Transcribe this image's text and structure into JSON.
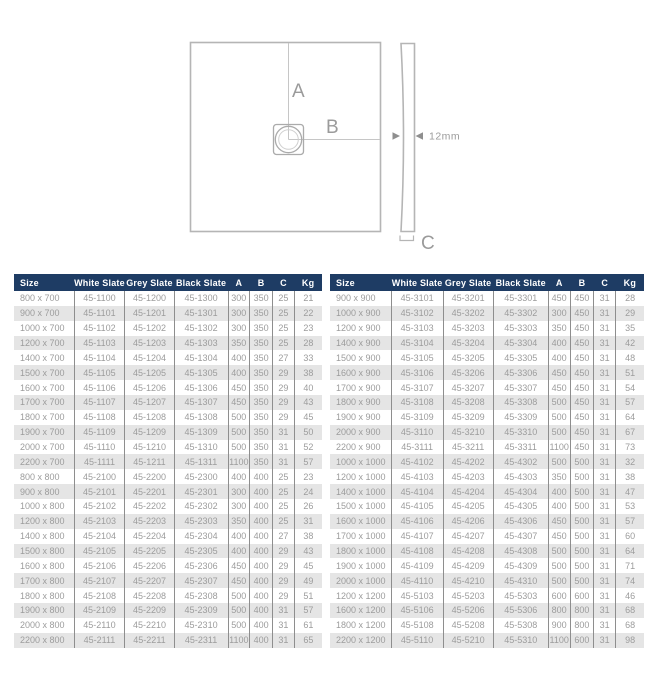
{
  "diagram": {
    "label_a": "A",
    "label_b": "B",
    "label_c": "C",
    "thickness_label": "12mm"
  },
  "colors": {
    "header_bg": "#1e3c64",
    "header_text": "#ffffff",
    "row_alt": "#e5e5e5",
    "body_text": "#9c9c9c",
    "divider": "#8e8e8e",
    "diagram_stroke": "#b5b5b5"
  },
  "tables": [
    {
      "columns": [
        "Size",
        "White Slate",
        "Grey Slate",
        "Black Slate",
        "A",
        "B",
        "C",
        "Kg"
      ],
      "rows": [
        [
          "800 x 700",
          "45-1100",
          "45-1200",
          "45-1300",
          "300",
          "350",
          "25",
          "21"
        ],
        [
          "900 x 700",
          "45-1101",
          "45-1201",
          "45-1301",
          "300",
          "350",
          "25",
          "22"
        ],
        [
          "1000 x 700",
          "45-1102",
          "45-1202",
          "45-1302",
          "300",
          "350",
          "25",
          "23"
        ],
        [
          "1200 x 700",
          "45-1103",
          "45-1203",
          "45-1303",
          "350",
          "350",
          "25",
          "28"
        ],
        [
          "1400 x 700",
          "45-1104",
          "45-1204",
          "45-1304",
          "400",
          "350",
          "27",
          "33"
        ],
        [
          "1500 x 700",
          "45-1105",
          "45-1205",
          "45-1305",
          "400",
          "350",
          "29",
          "38"
        ],
        [
          "1600 x 700",
          "45-1106",
          "45-1206",
          "45-1306",
          "450",
          "350",
          "29",
          "40"
        ],
        [
          "1700 x 700",
          "45-1107",
          "45-1207",
          "45-1307",
          "450",
          "350",
          "29",
          "43"
        ],
        [
          "1800 x 700",
          "45-1108",
          "45-1208",
          "45-1308",
          "500",
          "350",
          "29",
          "45"
        ],
        [
          "1900 x 700",
          "45-1109",
          "45-1209",
          "45-1309",
          "500",
          "350",
          "31",
          "50"
        ],
        [
          "2000 x 700",
          "45-1110",
          "45-1210",
          "45-1310",
          "500",
          "350",
          "31",
          "52"
        ],
        [
          "2200 x 700",
          "45-1111",
          "45-1211",
          "45-1311",
          "1100",
          "350",
          "31",
          "57"
        ],
        [
          "800 x 800",
          "45-2100",
          "45-2200",
          "45-2300",
          "400",
          "400",
          "25",
          "23"
        ],
        [
          "900 x 800",
          "45-2101",
          "45-2201",
          "45-2301",
          "300",
          "400",
          "25",
          "24"
        ],
        [
          "1000 x 800",
          "45-2102",
          "45-2202",
          "45-2302",
          "300",
          "400",
          "25",
          "26"
        ],
        [
          "1200 x 800",
          "45-2103",
          "45-2203",
          "45-2303",
          "350",
          "400",
          "25",
          "31"
        ],
        [
          "1400 x 800",
          "45-2104",
          "45-2204",
          "45-2304",
          "400",
          "400",
          "27",
          "38"
        ],
        [
          "1500 x 800",
          "45-2105",
          "45-2205",
          "45-2305",
          "400",
          "400",
          "29",
          "43"
        ],
        [
          "1600 x 800",
          "45-2106",
          "45-2206",
          "45-2306",
          "450",
          "400",
          "29",
          "45"
        ],
        [
          "1700 x 800",
          "45-2107",
          "45-2207",
          "45-2307",
          "450",
          "400",
          "29",
          "49"
        ],
        [
          "1800 x 800",
          "45-2108",
          "45-2208",
          "45-2308",
          "500",
          "400",
          "29",
          "51"
        ],
        [
          "1900 x 800",
          "45-2109",
          "45-2209",
          "45-2309",
          "500",
          "400",
          "31",
          "57"
        ],
        [
          "2000 x 800",
          "45-2110",
          "45-2210",
          "45-2310",
          "500",
          "400",
          "31",
          "61"
        ],
        [
          "2200 x 800",
          "45-2111",
          "45-2211",
          "45-2311",
          "1100",
          "400",
          "31",
          "65"
        ]
      ]
    },
    {
      "columns": [
        "Size",
        "White Slate",
        "Grey Slate",
        "Black Slate",
        "A",
        "B",
        "C",
        "Kg"
      ],
      "rows": [
        [
          "900 x 900",
          "45-3101",
          "45-3201",
          "45-3301",
          "450",
          "450",
          "31",
          "28"
        ],
        [
          "1000 x 900",
          "45-3102",
          "45-3202",
          "45-3302",
          "300",
          "450",
          "31",
          "29"
        ],
        [
          "1200 x 900",
          "45-3103",
          "45-3203",
          "45-3303",
          "350",
          "450",
          "31",
          "35"
        ],
        [
          "1400 x 900",
          "45-3104",
          "45-3204",
          "45-3304",
          "400",
          "450",
          "31",
          "42"
        ],
        [
          "1500 x 900",
          "45-3105",
          "45-3205",
          "45-3305",
          "400",
          "450",
          "31",
          "48"
        ],
        [
          "1600 x 900",
          "45-3106",
          "45-3206",
          "45-3306",
          "450",
          "450",
          "31",
          "51"
        ],
        [
          "1700 x 900",
          "45-3107",
          "45-3207",
          "45-3307",
          "450",
          "450",
          "31",
          "54"
        ],
        [
          "1800 x 900",
          "45-3108",
          "45-3208",
          "45-3308",
          "500",
          "450",
          "31",
          "57"
        ],
        [
          "1900 x 900",
          "45-3109",
          "45-3209",
          "45-3309",
          "500",
          "450",
          "31",
          "64"
        ],
        [
          "2000 x 900",
          "45-3110",
          "45-3210",
          "45-3310",
          "500",
          "450",
          "31",
          "67"
        ],
        [
          "2200 x 900",
          "45-3111",
          "45-3211",
          "45-3311",
          "1100",
          "450",
          "31",
          "73"
        ],
        [
          "1000 x 1000",
          "45-4102",
          "45-4202",
          "45-4302",
          "500",
          "500",
          "31",
          "32"
        ],
        [
          "1200 x 1000",
          "45-4103",
          "45-4203",
          "45-4303",
          "350",
          "500",
          "31",
          "38"
        ],
        [
          "1400 x 1000",
          "45-4104",
          "45-4204",
          "45-4304",
          "400",
          "500",
          "31",
          "47"
        ],
        [
          "1500 x 1000",
          "45-4105",
          "45-4205",
          "45-4305",
          "400",
          "500",
          "31",
          "53"
        ],
        [
          "1600 x 1000",
          "45-4106",
          "45-4206",
          "45-4306",
          "450",
          "500",
          "31",
          "57"
        ],
        [
          "1700 x 1000",
          "45-4107",
          "45-4207",
          "45-4307",
          "450",
          "500",
          "31",
          "60"
        ],
        [
          "1800 x 1000",
          "45-4108",
          "45-4208",
          "45-4308",
          "500",
          "500",
          "31",
          "64"
        ],
        [
          "1900 x 1000",
          "45-4109",
          "45-4209",
          "45-4309",
          "500",
          "500",
          "31",
          "71"
        ],
        [
          "2000 x 1000",
          "45-4110",
          "45-4210",
          "45-4310",
          "500",
          "500",
          "31",
          "74"
        ],
        [
          "1200 x 1200",
          "45-5103",
          "45-5203",
          "45-5303",
          "600",
          "600",
          "31",
          "46"
        ],
        [
          "1600 x 1200",
          "45-5106",
          "45-5206",
          "45-5306",
          "800",
          "800",
          "31",
          "68"
        ],
        [
          "1800 x 1200",
          "45-5108",
          "45-5208",
          "45-5308",
          "900",
          "800",
          "31",
          "68"
        ],
        [
          "2200 x 1200",
          "45-5110",
          "45-5210",
          "45-5310",
          "1100",
          "600",
          "31",
          "98"
        ]
      ]
    }
  ]
}
